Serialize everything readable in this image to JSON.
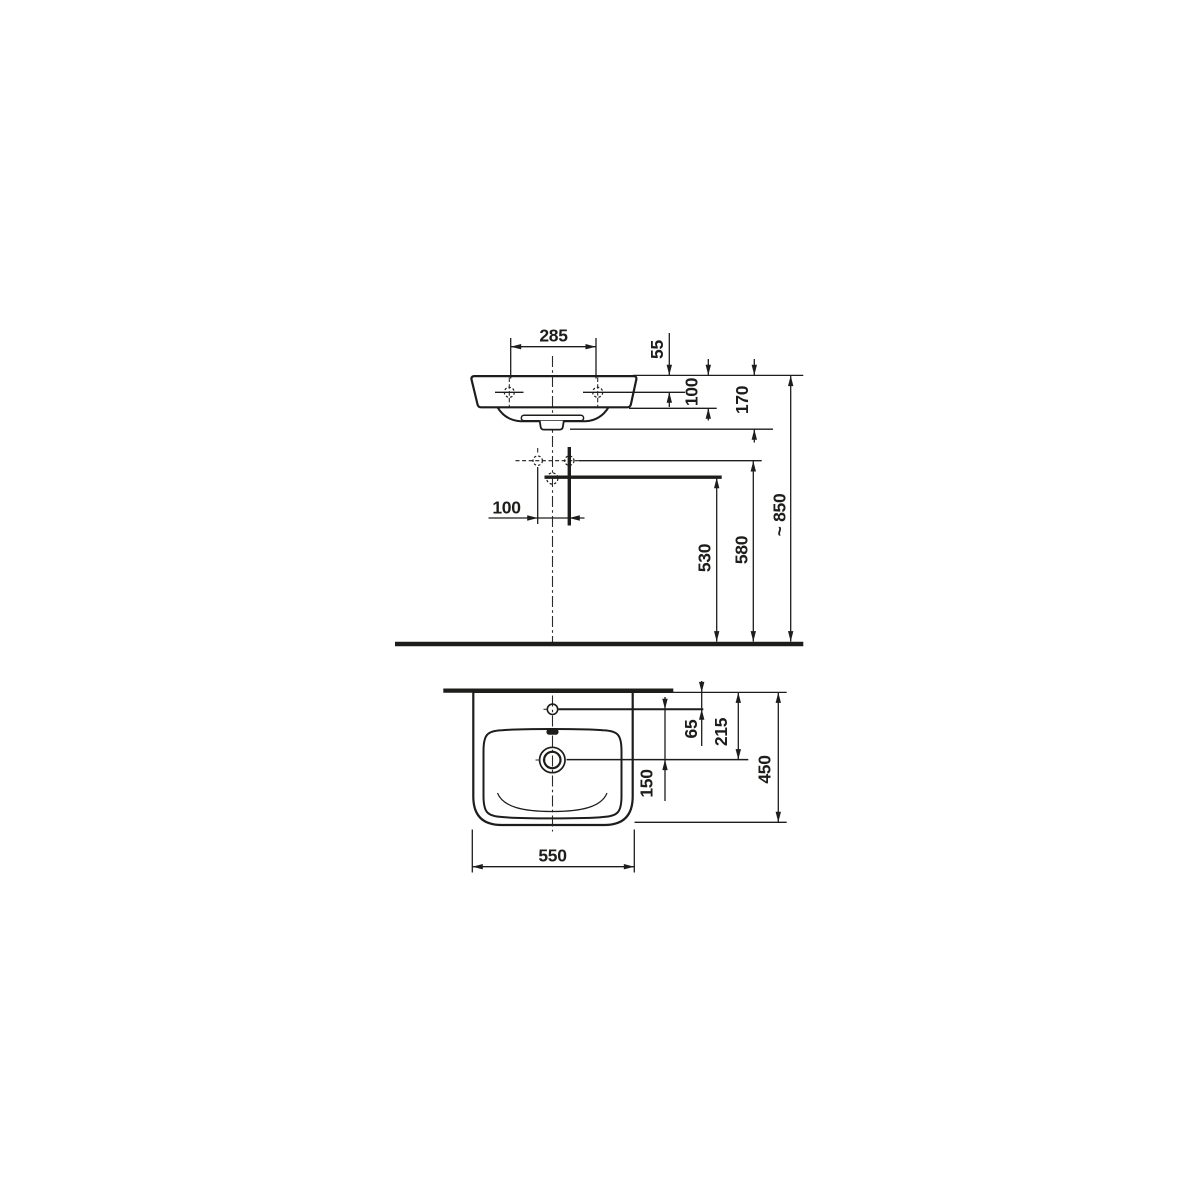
{
  "drawing": {
    "front_view": {
      "tap_hole_spacing_mm": "285",
      "rim_to_fixing_holes_mm": "55",
      "apron_height_mm": "100",
      "overall_depth_mm": "170",
      "connection_offset_mm": "100",
      "floor_to_drain_mm": "530",
      "floor_to_connections_mm": "580",
      "floor_to_rim_mm": "~ 850"
    },
    "top_view": {
      "wall_to_tap_hole_mm": "65",
      "wall_to_drain_mm": "215",
      "tap_hole_to_drain_mm": "150",
      "basin_depth_mm": "450",
      "basin_width_mm": "550"
    },
    "colors": {
      "line": "#1d1d1b",
      "background": "#ffffff"
    }
  }
}
